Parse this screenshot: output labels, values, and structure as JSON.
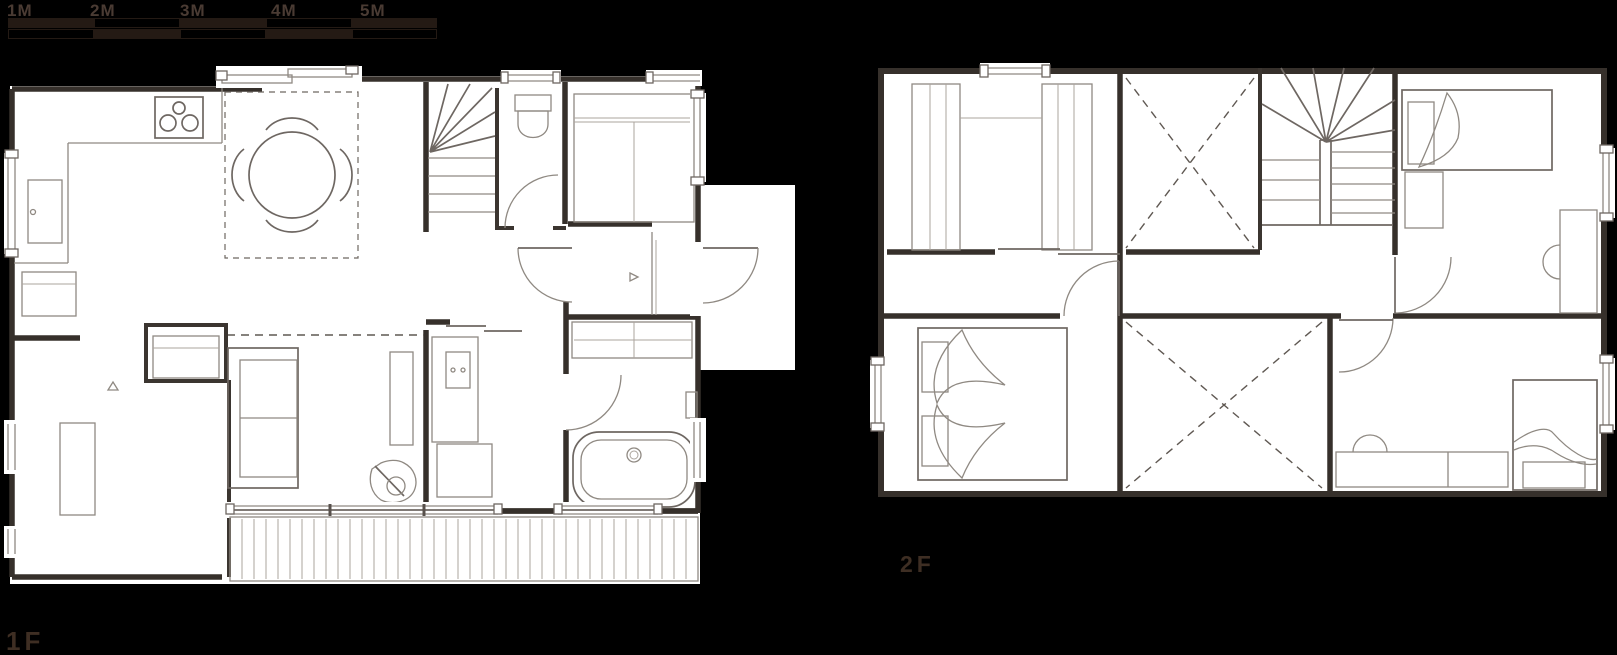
{
  "scale_bar": {
    "labels": [
      "1M",
      "2M",
      "3M",
      "4M",
      "5M"
    ],
    "unit": "meters",
    "total_meters": 5
  },
  "floor_labels": {
    "first": "1F",
    "second": "2F"
  },
  "colors": {
    "background": "#000000",
    "plan_fill": "#ffffff",
    "wall": "#36302b",
    "line_mid": "#6e6762",
    "line_light": "#8f8982",
    "dash": "#5f5852",
    "scale_fill": "#241a14",
    "label_text": "#3e2e23"
  },
  "plans": {
    "first_floor": {
      "label": "1F",
      "features": [
        "kitchen-counter",
        "cooktop",
        "sink",
        "dining-table-with-chairs",
        "stairs",
        "toilet",
        "storage-closet",
        "entrance-porch",
        "entry-door",
        "washbasin",
        "washing-machine",
        "bathtub",
        "sofa",
        "closet",
        "tv-board",
        "lounge-chair",
        "bedroom-desk",
        "wood-deck"
      ]
    },
    "second_floor": {
      "label": "2F",
      "features": [
        "walk-in-closet",
        "void-open-to-below",
        "stairs",
        "master-bed",
        "single-bed",
        "single-bed",
        "desk-with-chair",
        "desk-with-chair",
        "corridor-doors"
      ]
    }
  }
}
